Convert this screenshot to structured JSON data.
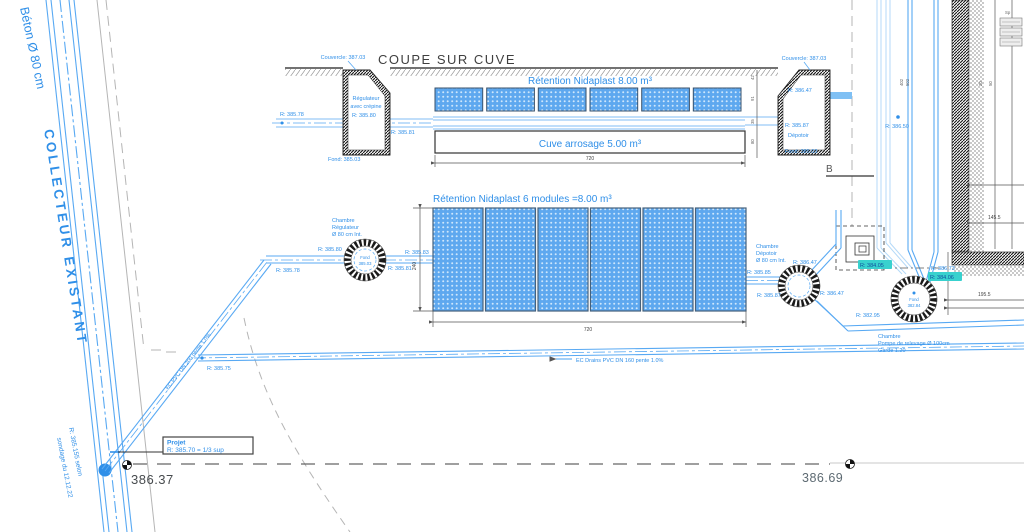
{
  "colors": {
    "cad_blue": "#2f8fe8",
    "pipe_blue": "#58a9f3",
    "light_blue": "#b4d9f8",
    "module_fill": "#5ea8ef",
    "teal_highlight_bg": "#38d1ce",
    "teal_highlight_text": "#114f9e",
    "dark_text": "#3f3f3f",
    "survey_text": "#5d6a72"
  },
  "collector": {
    "beton": "Béton Ø 80 cm",
    "existant": "COLLECTEUR EXISTANT",
    "note1": "R: 385.155 selon",
    "note2": "sondage du 12.12.22"
  },
  "section": {
    "title": "COUPE SUR CUVE",
    "left_chamber": {
      "couvercle": "Couvercle: 387.03",
      "name1": "Régulateur",
      "name2": "avec crépine",
      "r_left": "R: 385.78",
      "r_in": "R: 385.80",
      "r_out": "R: 385.81",
      "fond": "Fond: 385.03"
    },
    "retention_label": "Rétention Nidaplast 8.00 m³",
    "cuve_label": "Cuve arrosage 5.00 m³",
    "dim_width": "720",
    "dims_small": [
      "42",
      "91",
      "35",
      "80"
    ],
    "right_chamber": {
      "couvercle": "Couvercle: 387.03",
      "r_top": "R: 386.47",
      "r_in": "R: 385.87",
      "name": "Dépotoir",
      "fond": "Fond: 385.03"
    }
  },
  "plan": {
    "title": "Rétention Nidaplast 6 modules =8.00 m³",
    "dim_height": "240",
    "dim_width": "720",
    "regulateur": {
      "l1": "Chambre",
      "l2": "Régulateur",
      "l3": "Ø 80 cm Int.",
      "fond1": "Fond",
      "fond2": "385.03",
      "r_up": "R: 385.80",
      "r_diag": "R: 385.78",
      "r_out": "R: 385.81",
      "r_rect": "R: 385.83"
    },
    "depotoir": {
      "l1": "Chambre",
      "l2": "Dépotoir",
      "l3": "Ø 80 cm Int.",
      "r_left": "R: 385.85",
      "r_in": "R: 385.87",
      "r_up": "R: 386.47",
      "r_down": "R: 386.47"
    },
    "pompe": {
      "l1": "Chambre",
      "l2": "Pompe de relevage Ø 100cm",
      "l3": "Garde 1.20",
      "fond1": "Fond",
      "fond2": "382.84",
      "r_left_hl": "R: 384.05",
      "r_bottom": "R: 382.95",
      "r_right": "R: 386.73",
      "r_right_hl": "R: 384.06"
    },
    "r_wall": "R: 386.50",
    "marker_b": "B",
    "dim_right": "195.5",
    "dim_wall": "145.5",
    "micro": [
      "402",
      "502",
      "20",
      "50"
    ],
    "legend": "Sp"
  },
  "pipes": {
    "drain_label": "EC Drains PVC DN 160 pente 1.0%",
    "diag_label": "EC PVC DN 200 pente 1.0%",
    "r_drain": "R: 385.75"
  },
  "survey": {
    "projet1": "Projet",
    "projet2": "R: 385.70 = 1/3 sup",
    "bm1": "386.37",
    "bm2": "386.69"
  }
}
